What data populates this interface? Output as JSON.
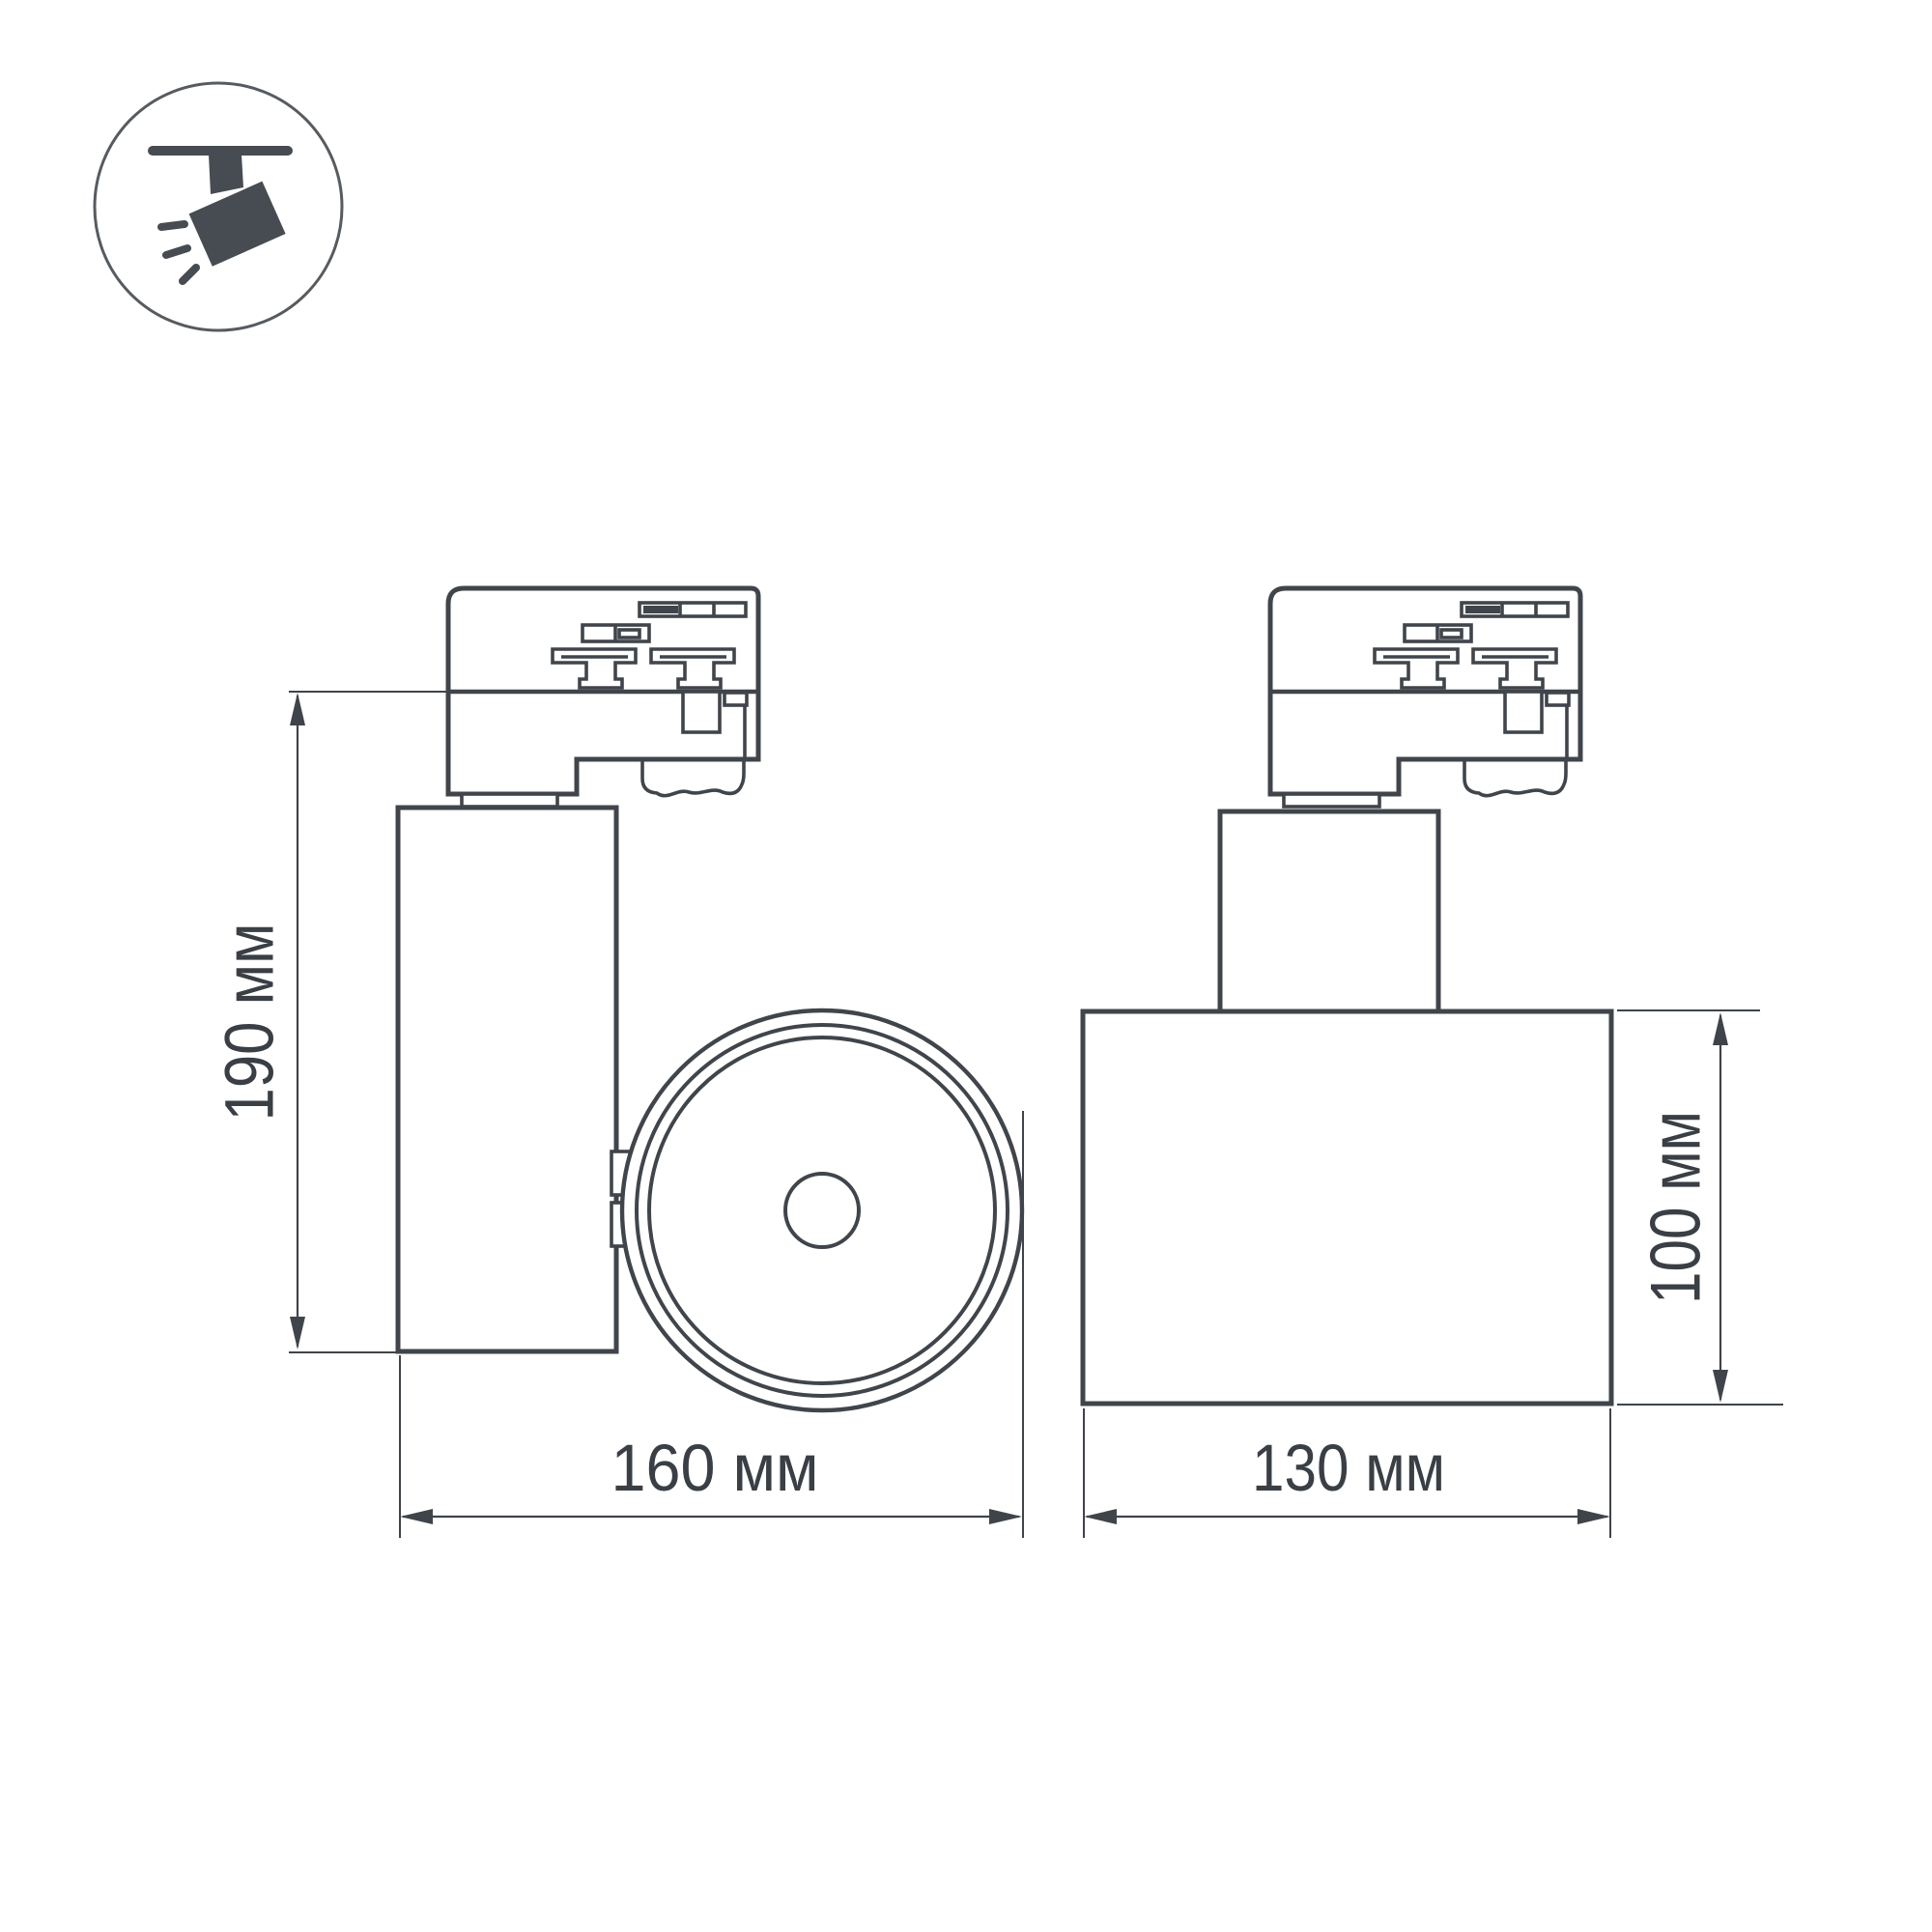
{
  "icon": {
    "name": "track-spotlight-icon"
  },
  "dimensions": {
    "left_height": "190 мм",
    "left_width": "160 мм",
    "right_width": "130 мм",
    "right_height": "100 мм"
  },
  "colors": {
    "line": "#40454b",
    "dimension": "#3f444a",
    "text": "#3a3f45",
    "icon_glyph": "#474c52",
    "background": "#ffffff"
  }
}
